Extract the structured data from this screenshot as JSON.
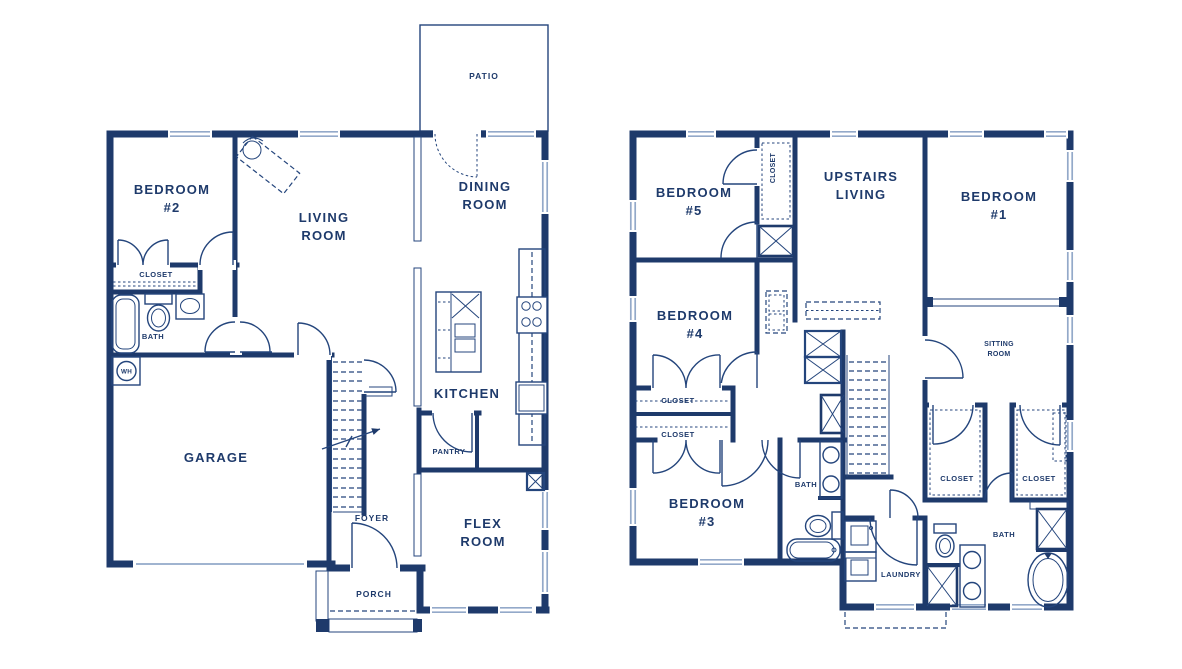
{
  "palette": {
    "ink": "#1e3a6b",
    "line": "#24457c",
    "window_line": "#93a9c9",
    "background": "#ffffff"
  },
  "floor1": {
    "rooms": {
      "patio": "PATIO",
      "bedroom2": [
        "BEDROOM",
        "#2"
      ],
      "living": [
        "LIVING",
        "ROOM"
      ],
      "dining": [
        "DINING",
        "ROOM"
      ],
      "closet": "CLOSET",
      "bath": "BATH",
      "water_heater": "WH",
      "garage": "GARAGE",
      "kitchen": "KITCHEN",
      "pantry": "PANTRY",
      "foyer": "FOYER",
      "flex": [
        "FLEX",
        "ROOM"
      ],
      "porch": "PORCH"
    }
  },
  "floor2": {
    "rooms": {
      "bedroom5": [
        "BEDROOM",
        "#5"
      ],
      "closet5": "CLOSET",
      "upstairs_living": [
        "UPSTAIRS",
        "LIVING"
      ],
      "bedroom1": [
        "BEDROOM",
        "#1"
      ],
      "bedroom4": [
        "BEDROOM",
        "#4"
      ],
      "sitting": [
        "SITTING",
        "ROOM"
      ],
      "hall_closet_top": "CLOSET",
      "hall_closet_bottom": "CLOSET",
      "bedroom3": [
        "BEDROOM",
        "#3"
      ],
      "bath1": "BATH",
      "laundry": "LAUNDRY",
      "closet_a": "CLOSET",
      "closet_b": "CLOSET",
      "bath2": "BATH"
    }
  }
}
